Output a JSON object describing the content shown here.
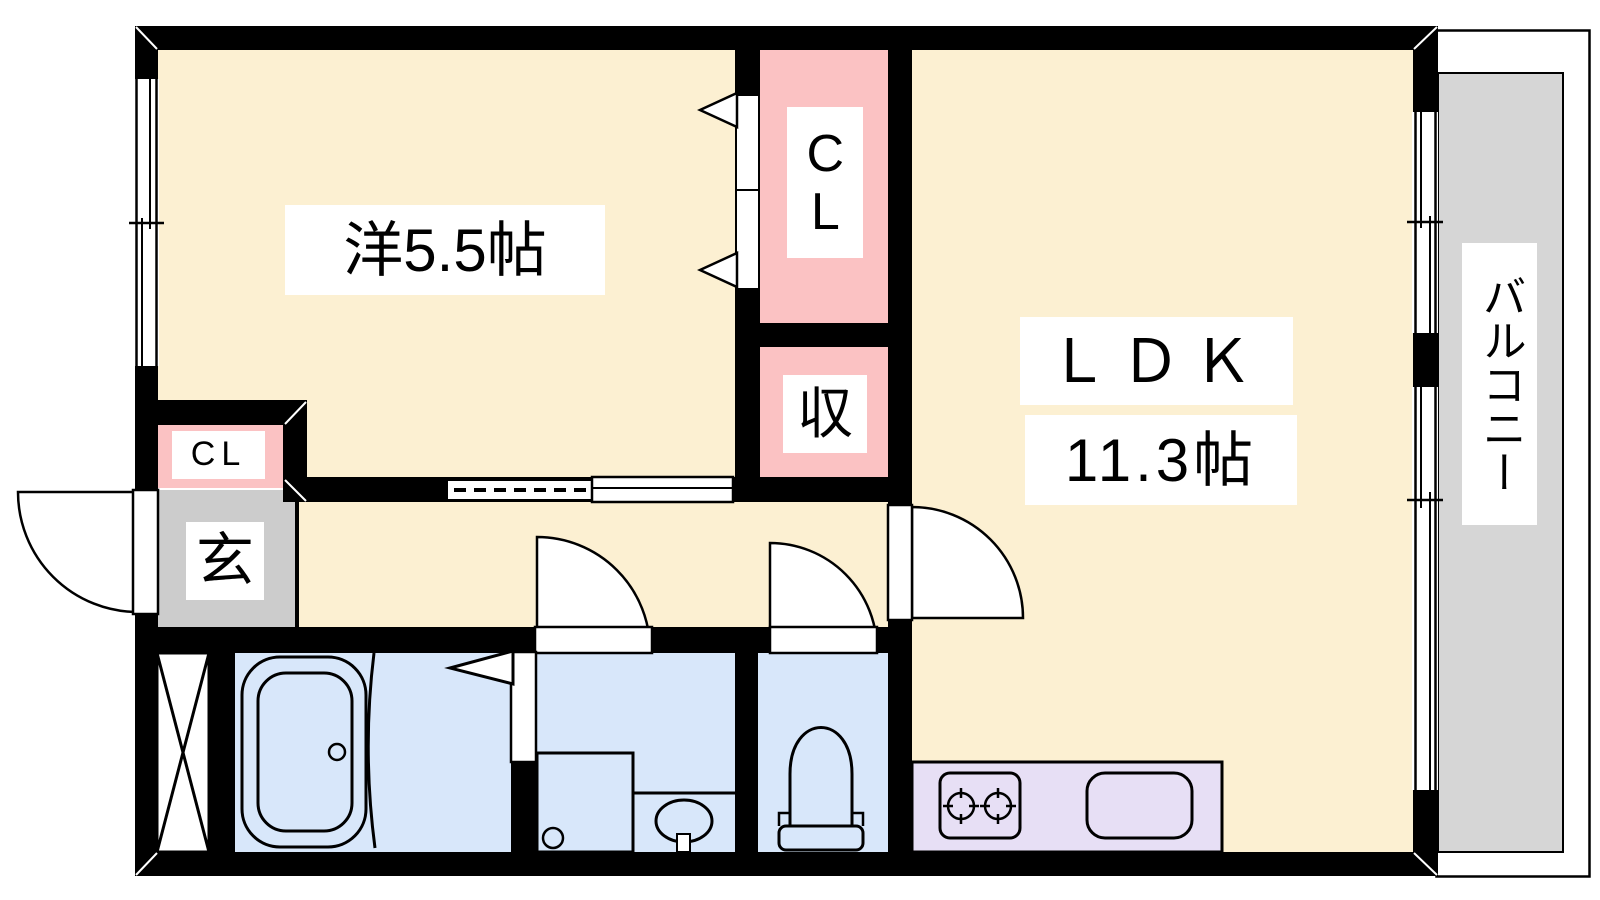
{
  "rooms": {
    "western_room": {
      "label": "洋5.5帖"
    },
    "ldk": {
      "name": "ＬＤＫ",
      "size": "11.3帖"
    },
    "closet_main": {
      "label": "CL"
    },
    "storage": {
      "label": "収"
    },
    "closet_entry": {
      "label": "CL"
    },
    "entrance": {
      "label": "玄"
    },
    "balcony": {
      "label": "バルコニー"
    }
  },
  "colors": {
    "room_cream": "#FCF0D2",
    "closet_pink": "#FBC2C3",
    "wet_area_blue": "#D8E7FA",
    "entrance_gray": "#CCCCCC",
    "balcony_gray": "#D6D6D6",
    "kitchen_lavender": "#E7DFF5",
    "wall_black": "#000000"
  }
}
